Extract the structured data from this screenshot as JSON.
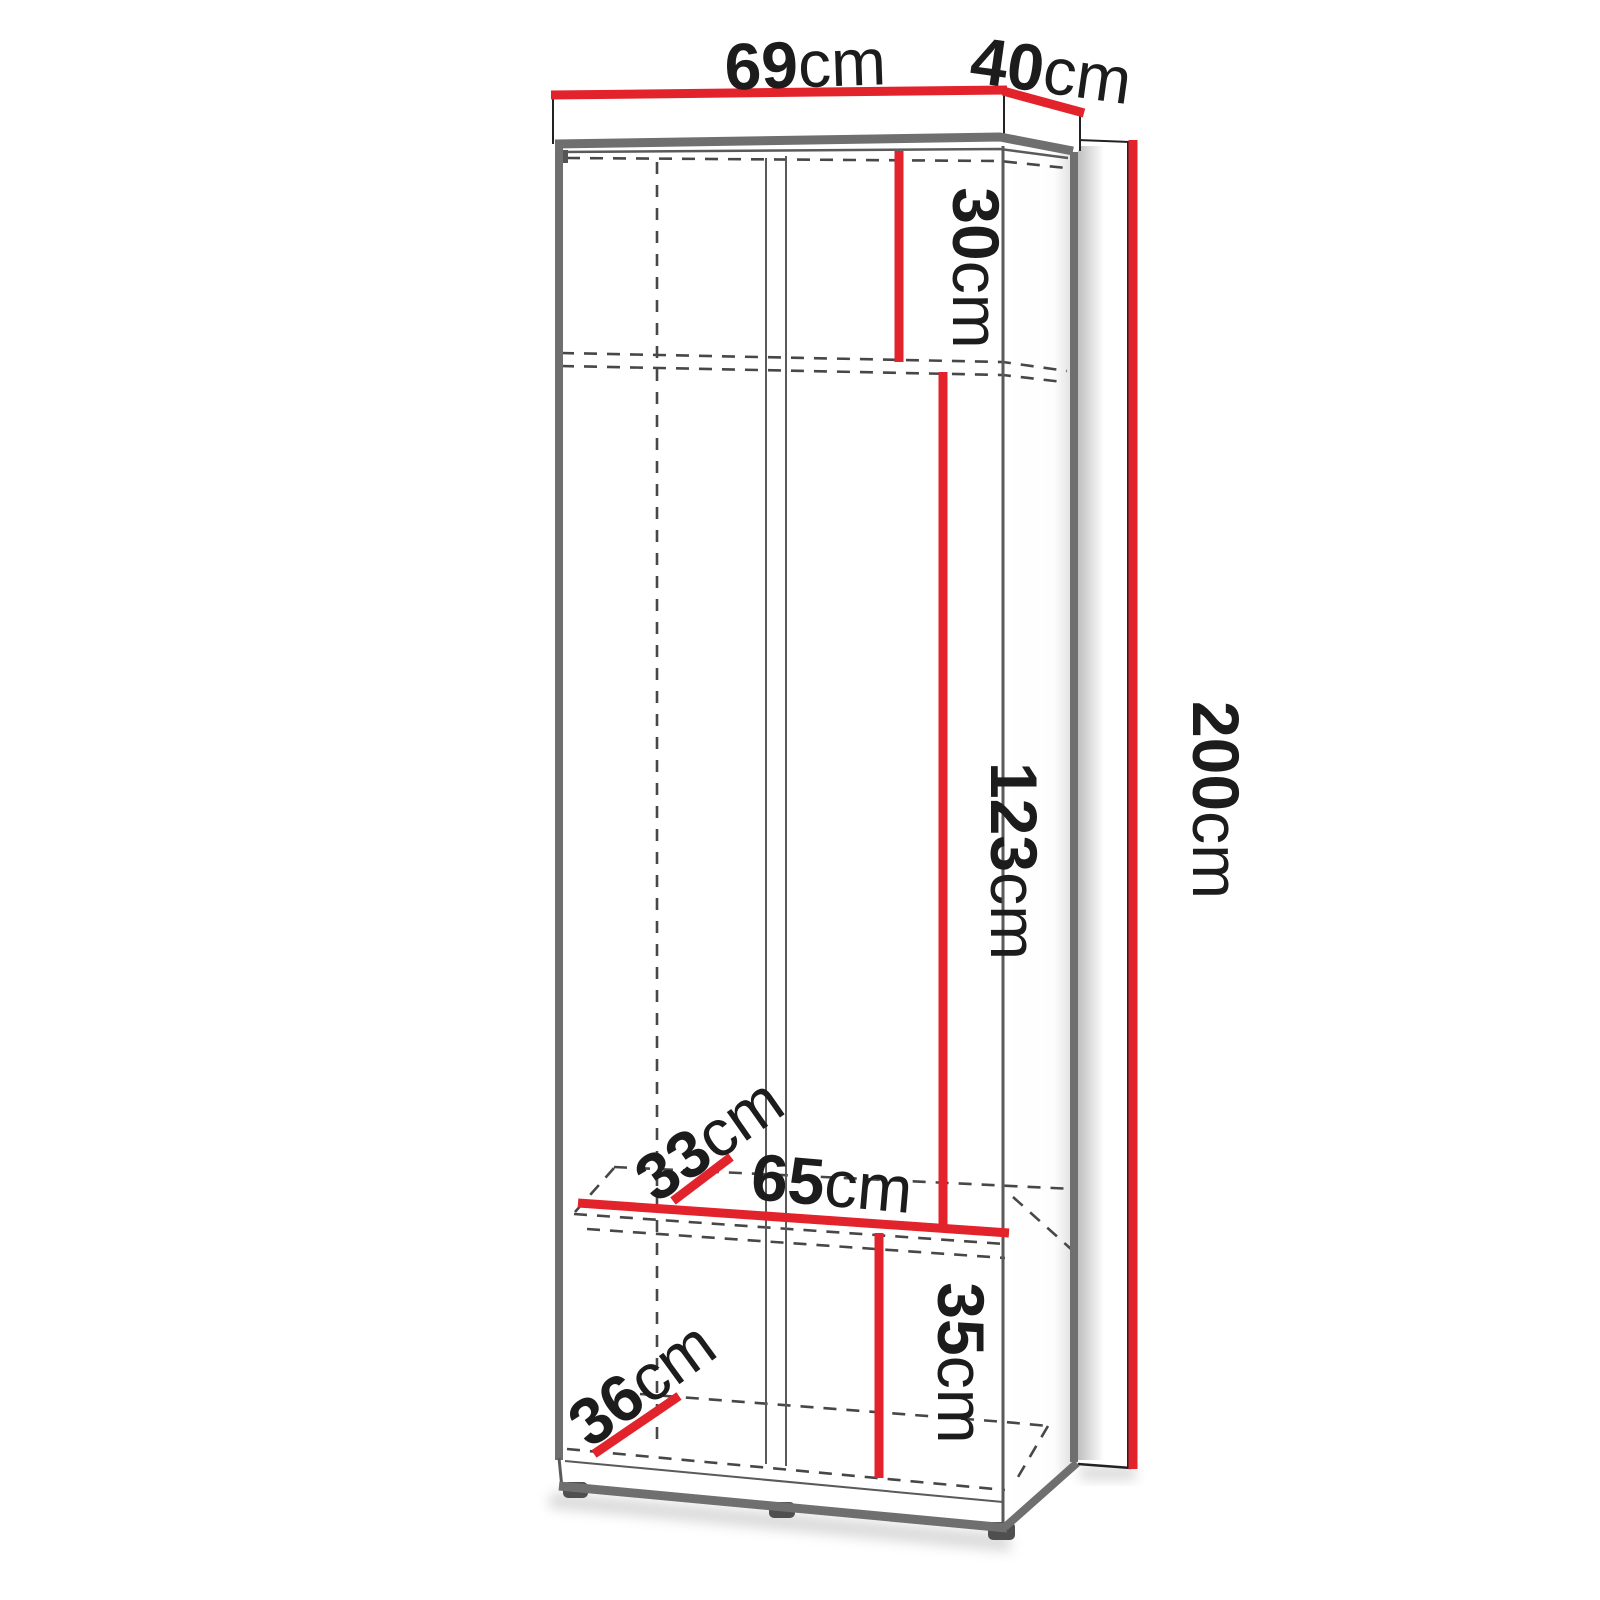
{
  "theme": {
    "bg": "#ffffff",
    "accent": "#e2232b",
    "edge": "#6f6f6f",
    "thin": "#5a5a5a",
    "dash": "#474747",
    "outline": "#222222",
    "text": "#1c1c1c"
  },
  "diagram": {
    "kind": "wardrobe-dimension-diagram",
    "unit": "cm",
    "labels": {
      "width": {
        "value": "69",
        "unit": "cm"
      },
      "depth": {
        "value": "40",
        "unit": "cm"
      },
      "top_compartment_height": {
        "value": "30",
        "unit": "cm"
      },
      "middle_compartment_height": {
        "value": "123",
        "unit": "cm"
      },
      "total_height": {
        "value": "200",
        "unit": "cm"
      },
      "shelf_width": {
        "value": "65",
        "unit": "cm"
      },
      "shelf_depth": {
        "value": "33",
        "unit": "cm"
      },
      "bottom_compartment_height": {
        "value": "35",
        "unit": "cm"
      },
      "bottom_shelf_depth": {
        "value": "36",
        "unit": "cm"
      }
    }
  }
}
